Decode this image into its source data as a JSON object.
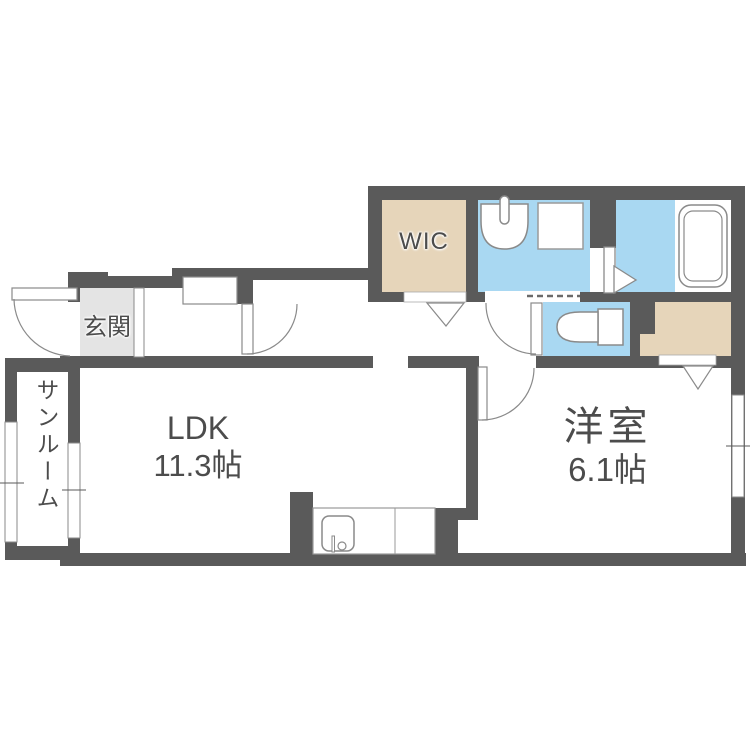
{
  "plan": {
    "type": "apartment-floor-plan",
    "rooms": {
      "ldk": {
        "label": "LDK",
        "size": "11.3帖"
      },
      "yoshitsu": {
        "label": "洋室",
        "size": "6.1帖"
      },
      "sunroom": {
        "label": "サンルーム"
      },
      "genkan": {
        "label": "玄関"
      },
      "wic": {
        "label": "WIC"
      }
    },
    "icons": {
      "bathtub": "bathtub-icon",
      "toilet": "toilet-icon",
      "washbasin": "washbasin-icon",
      "washer_pan": "washing-machine-pan-icon",
      "kitchen_sink": "kitchen-sink-icon",
      "door_swing": "door-swing-arc-icon",
      "folding_door": "folding-door-marker-icon",
      "window": "window-icon"
    },
    "colors": {
      "wall": "#5a5a5a",
      "water": "#a9d8f2",
      "storage": "#e6d5ba",
      "tile": "#e4e4e4",
      "text": "#4c4c4c",
      "fixture_stroke": "#8a8a8a",
      "white": "#ffffff"
    }
  }
}
